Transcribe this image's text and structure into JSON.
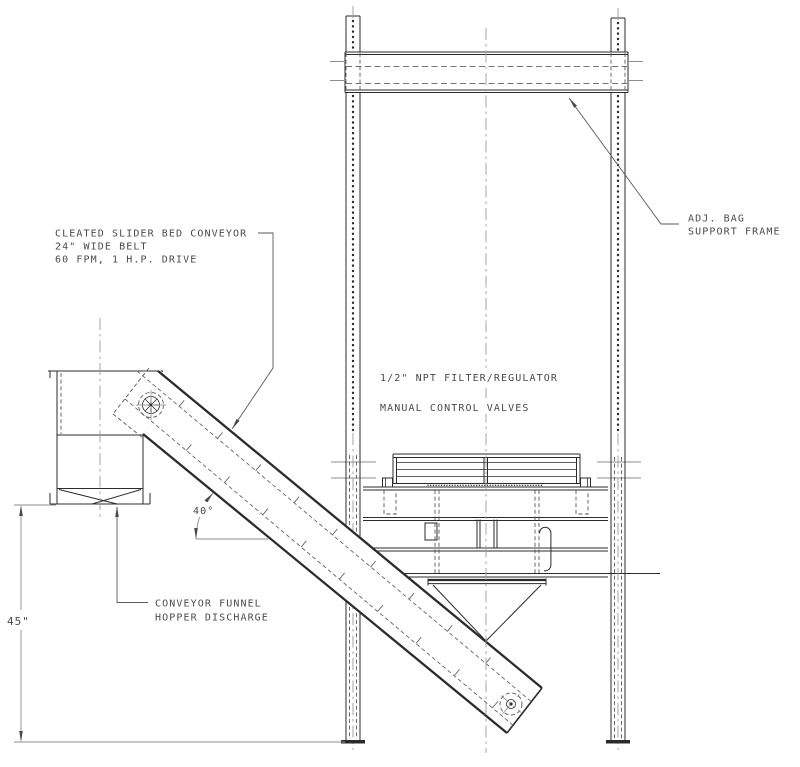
{
  "drawing": {
    "callouts": {
      "conveyor_line1": "CLEATED SLIDER BED CONVEYOR",
      "conveyor_line2": "24\" WIDE BELT",
      "conveyor_line3": "60 FPM, 1 H.P. DRIVE",
      "bag_frame_line1": "ADJ. BAG",
      "bag_frame_line2": "SUPPORT FRAME",
      "filter_regulator": "1/2\" NPT FILTER/REGULATOR",
      "control_valves": "MANUAL CONTROL VALVES",
      "hopper_line1": "CONVEYOR FUNNEL",
      "hopper_line2": "HOPPER DISCHARGE"
    },
    "dimensions": {
      "height": "45\"",
      "angle": "40°"
    },
    "colors": {
      "object_line": "#2b2b2b",
      "hidden_line": "#5a5a5a",
      "center_line": "#9b9b9b",
      "dimension_line": "#8e8e8e",
      "text": "#4a4a4a",
      "background": "#ffffff"
    }
  }
}
